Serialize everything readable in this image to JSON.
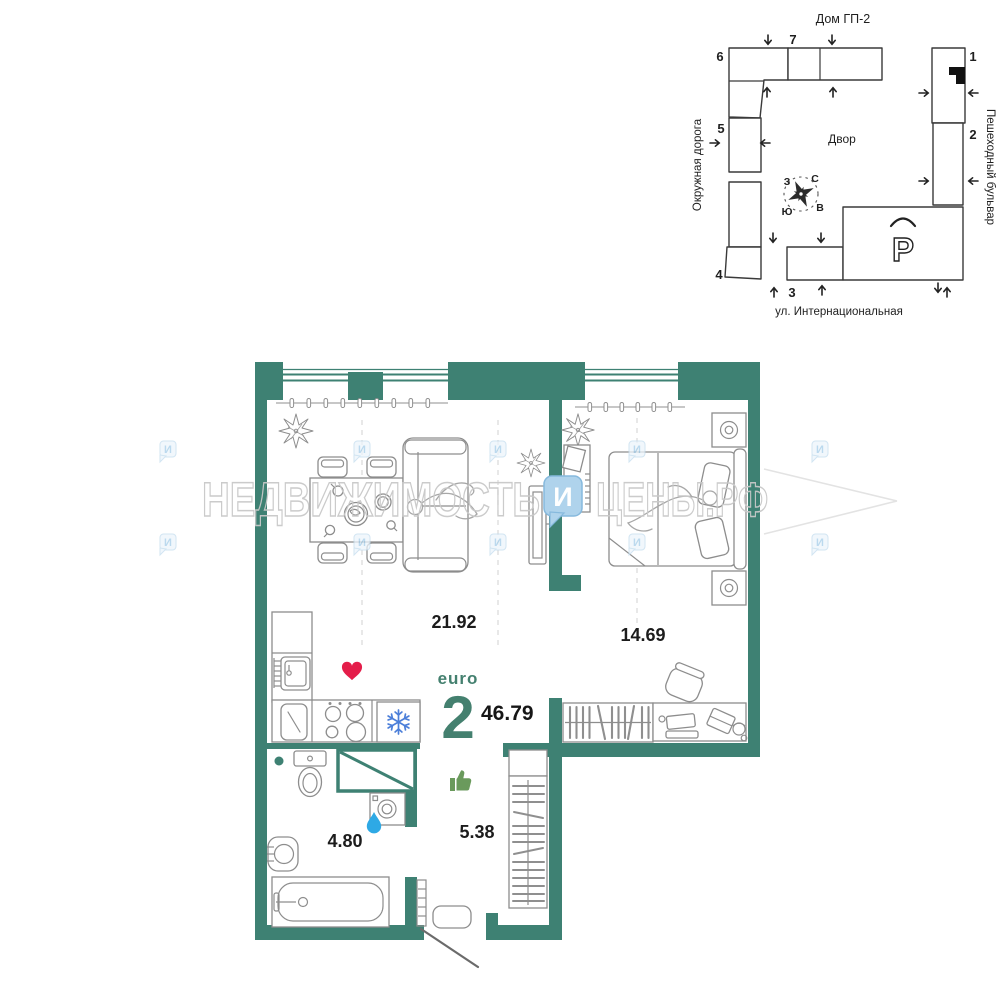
{
  "site_plan": {
    "title": "Дом ГП-2",
    "yard": "Двор",
    "parking_label": "P",
    "road_left": "Окружная дорога",
    "road_right": "Пешеходный бульвар",
    "road_bottom": "ул. Интернациональная",
    "buildings": [
      "1",
      "2",
      "3",
      "4",
      "5",
      "6",
      "7"
    ],
    "compass": {
      "n": "С",
      "s": "Ю",
      "w": "З",
      "e": "В"
    }
  },
  "apartment": {
    "layout_type": "euro",
    "rooms_count": "2",
    "total_area": "46.79",
    "areas": {
      "living_kitchen": "21.92",
      "bedroom": "14.69",
      "bathroom": "4.80",
      "hallway": "5.38"
    }
  },
  "watermark": {
    "left": "НЕДВИЖИМОСТЬ",
    "logo": "И",
    "right": "ЦЕНЫ.РФ"
  },
  "colors": {
    "wall": "#3E8173",
    "heart": "#E41D4A",
    "thumb": "#6A9A5C",
    "drop": "#2EA9E5",
    "snowflake": "#4C7FD9",
    "watermark_blue": "#AFD3EC"
  }
}
